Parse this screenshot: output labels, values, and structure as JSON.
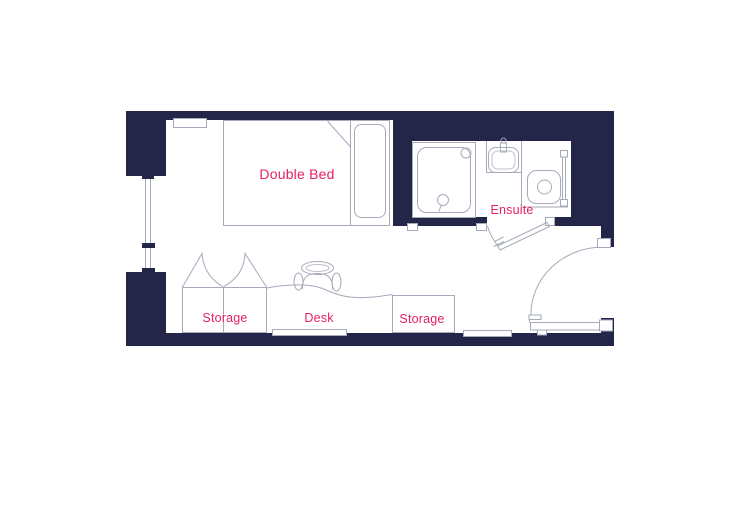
{
  "title": "Studio room floor plan",
  "colors": {
    "background": "#ffffff",
    "wall": "#232649",
    "line": "#a6aaba",
    "line_light": "#bfc2cd",
    "label": "#e7215f"
  },
  "labels": {
    "double_bed": "Double Bed",
    "ensuite": "Ensuite",
    "storage_left": "Storage",
    "desk": "Desk",
    "storage_right": "Storage"
  },
  "rooms": [
    {
      "name": "bedroom",
      "label": "Double Bed"
    },
    {
      "name": "ensuite",
      "label": "Ensuite"
    }
  ],
  "fixtures": [
    "window",
    "shelf",
    "double-bed",
    "pillow",
    "shower",
    "sink",
    "toilet",
    "towel-rail",
    "ensuite-door",
    "entrance-door",
    "wardrobe-left",
    "desk",
    "desk-chair",
    "wardrobe-right",
    "radiator-under-desk",
    "radiator-by-door"
  ]
}
